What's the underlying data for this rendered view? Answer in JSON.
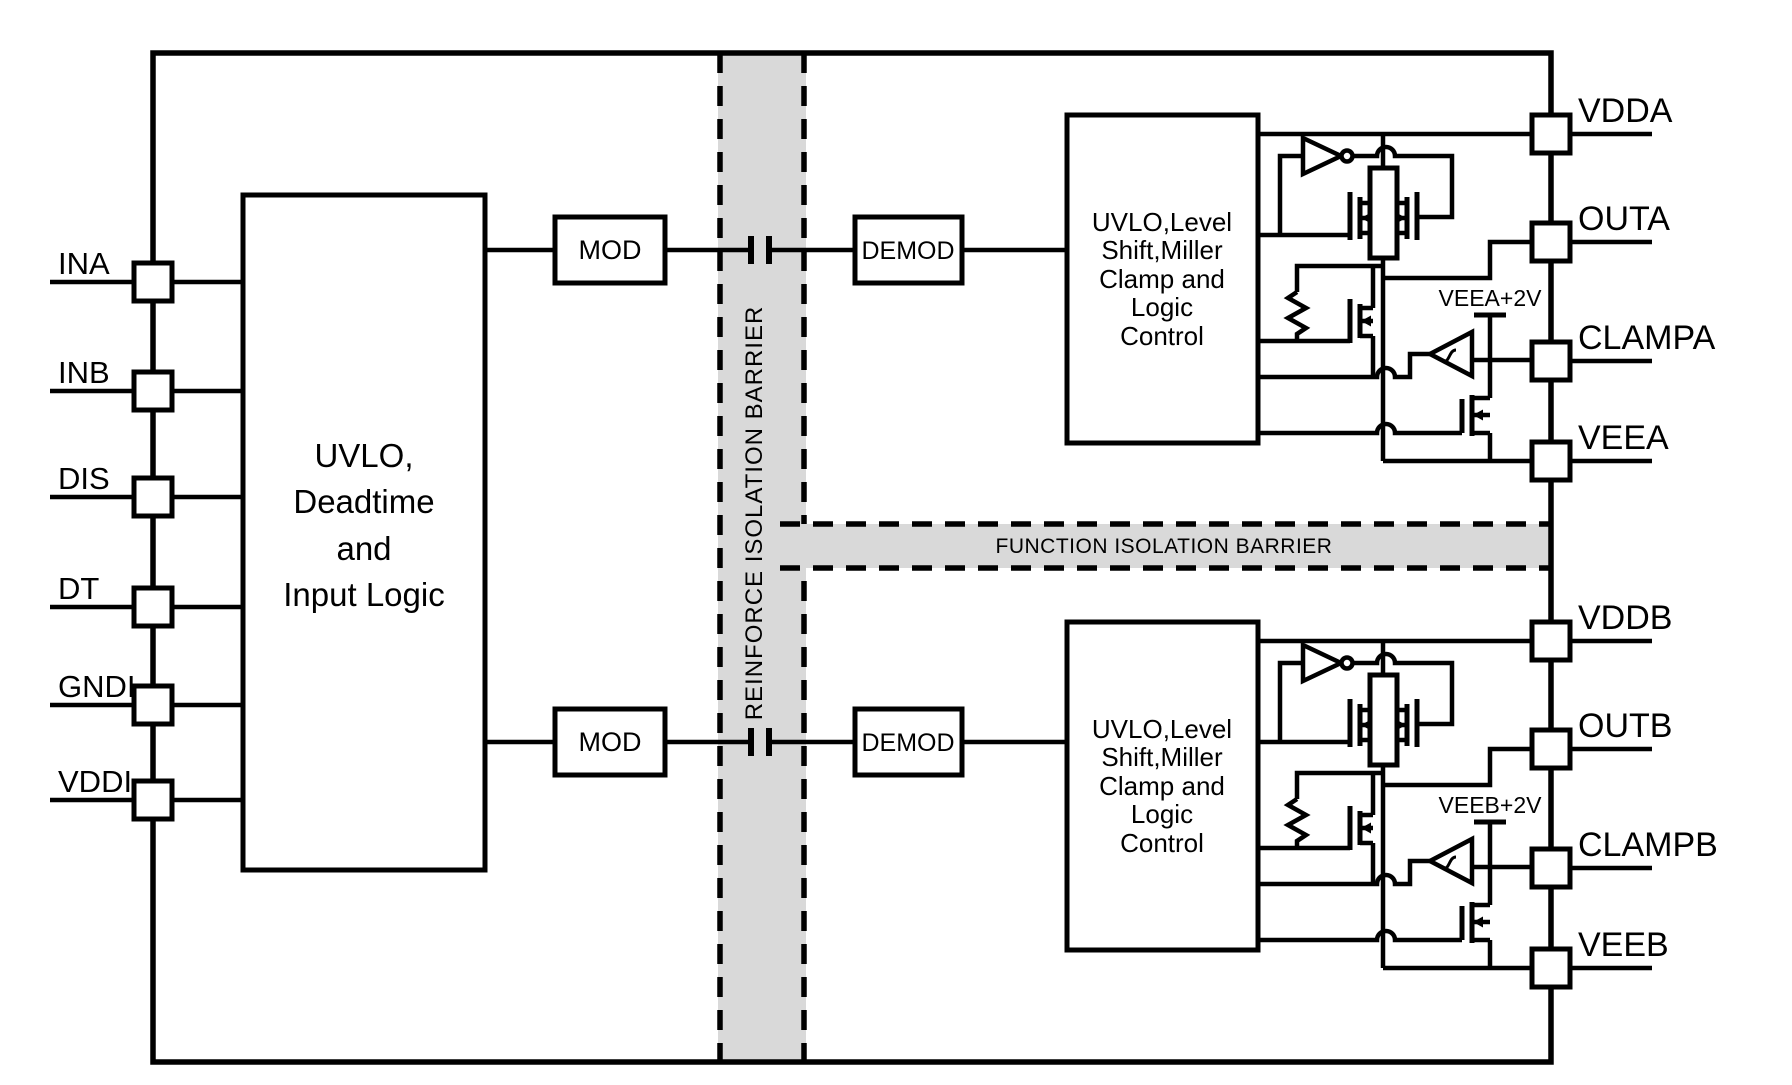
{
  "diagram": {
    "left_pins": [
      {
        "label": "INA"
      },
      {
        "label": "INB"
      },
      {
        "label": "DIS"
      },
      {
        "label": "DT"
      },
      {
        "label": "GNDI"
      },
      {
        "label": "VDDI"
      }
    ],
    "right_pins": [
      {
        "label": "VDDA"
      },
      {
        "label": "OUTA"
      },
      {
        "label": "CLAMPA"
      },
      {
        "label": "VEEA"
      },
      {
        "label": "VDDB"
      },
      {
        "label": "OUTB"
      },
      {
        "label": "CLAMPB"
      },
      {
        "label": "VEEB"
      }
    ],
    "input_block": {
      "lines": [
        "UVLO,",
        "Deadtime",
        "and",
        "Input Logic"
      ]
    },
    "output_block": {
      "lines": [
        "UVLO,Level",
        "Shift,Miller",
        "Clamp and",
        "Logic",
        "Control"
      ]
    },
    "mod_label": "MOD",
    "demod_label": "DEMOD",
    "barriers": {
      "vertical": "REINFORCE ISOLATION BARRIER",
      "horizontal": "FUNCTION ISOLATION BARRIER"
    },
    "clamp_refs": {
      "a": "VEEA+2V",
      "b": "VEEB+2V"
    },
    "colors": {
      "line": "#000000",
      "barrier_fill": "#d9d9d9",
      "background": "#ffffff"
    }
  }
}
